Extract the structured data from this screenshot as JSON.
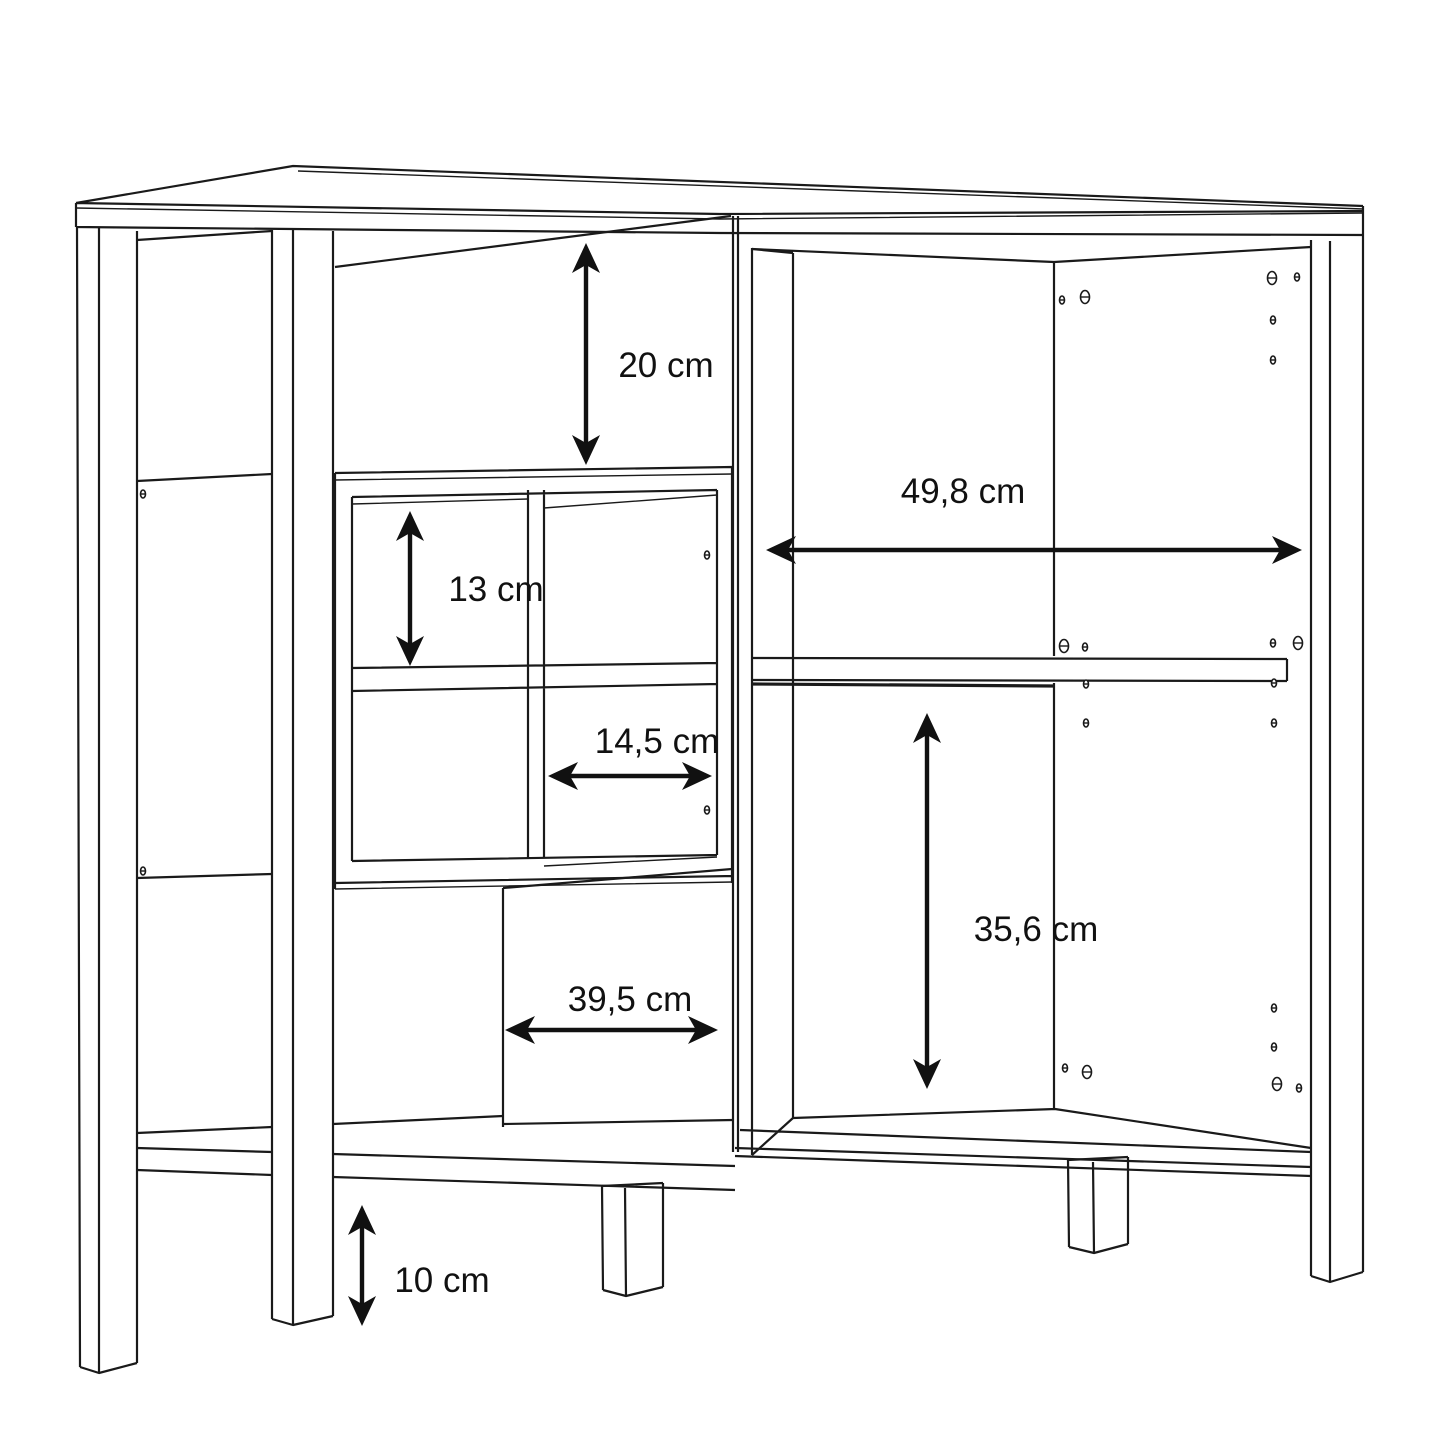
{
  "figure": {
    "type": "furniture-assembly-dimension-diagram",
    "subject": "sideboard-cabinet-line-drawing",
    "background_color": "#ffffff",
    "line_color": "#1a1a1a",
    "text_color": "#111111",
    "unit": "cm"
  },
  "dimensions": [
    {
      "id": "top-compartment-height",
      "value": "20",
      "unit": "cm",
      "label": "20 cm",
      "orientation": "vertical",
      "arrow": {
        "x": 586,
        "y1": 243,
        "y2": 465
      },
      "text": {
        "x": 666,
        "y": 377
      }
    },
    {
      "id": "cube-cell-height",
      "value": "13",
      "unit": "cm",
      "label": "13 cm",
      "orientation": "vertical",
      "arrow": {
        "x": 410,
        "y1": 511,
        "y2": 666
      },
      "text": {
        "x": 496,
        "y": 601
      }
    },
    {
      "id": "right-compartment-width",
      "value": "49,8",
      "unit": "cm",
      "label": "49,8 cm",
      "orientation": "horizontal",
      "arrow": {
        "y": 550,
        "x1": 766,
        "x2": 1302
      },
      "text": {
        "x": 963,
        "y": 503
      }
    },
    {
      "id": "cube-cell-width",
      "value": "14,5",
      "unit": "cm",
      "label": "14,5 cm",
      "orientation": "horizontal",
      "arrow": {
        "y": 776,
        "x1": 548,
        "x2": 712
      },
      "text": {
        "x": 657,
        "y": 753
      }
    },
    {
      "id": "right-compartment-height",
      "value": "35,6",
      "unit": "cm",
      "label": "35,6 cm",
      "orientation": "vertical",
      "arrow": {
        "x": 927,
        "y1": 713,
        "y2": 1089
      },
      "text": {
        "x": 1036,
        "y": 941
      }
    },
    {
      "id": "bottom-compartment-width",
      "value": "39,5",
      "unit": "cm",
      "label": "39,5 cm",
      "orientation": "horizontal",
      "arrow": {
        "y": 1030,
        "x1": 505,
        "x2": 718
      },
      "text": {
        "x": 630,
        "y": 1011
      }
    },
    {
      "id": "leg-height",
      "value": "10",
      "unit": "cm",
      "label": "10 cm",
      "orientation": "vertical",
      "arrow": {
        "x": 362,
        "y1": 1205,
        "y2": 1326
      },
      "text": {
        "x": 442,
        "y": 1292
      }
    }
  ],
  "screw_holes": [
    {
      "x": 143,
      "y": 494,
      "size": "small"
    },
    {
      "x": 143,
      "y": 871,
      "size": "small"
    },
    {
      "x": 707,
      "y": 555,
      "size": "small"
    },
    {
      "x": 707,
      "y": 810,
      "size": "small"
    },
    {
      "x": 1062,
      "y": 300,
      "size": "small"
    },
    {
      "x": 1085,
      "y": 297,
      "size": "large"
    },
    {
      "x": 1272,
      "y": 278,
      "size": "large"
    },
    {
      "x": 1297,
      "y": 277,
      "size": "small"
    },
    {
      "x": 1273,
      "y": 320,
      "size": "small"
    },
    {
      "x": 1273,
      "y": 360,
      "size": "small"
    },
    {
      "x": 1064,
      "y": 646,
      "size": "large"
    },
    {
      "x": 1085,
      "y": 647,
      "size": "small"
    },
    {
      "x": 1273,
      "y": 643,
      "size": "small"
    },
    {
      "x": 1298,
      "y": 643,
      "size": "large"
    },
    {
      "x": 1086,
      "y": 684,
      "size": "small"
    },
    {
      "x": 1274,
      "y": 683,
      "size": "small"
    },
    {
      "x": 1086,
      "y": 723,
      "size": "small"
    },
    {
      "x": 1274,
      "y": 723,
      "size": "small"
    },
    {
      "x": 1274,
      "y": 1008,
      "size": "small"
    },
    {
      "x": 1274,
      "y": 1047,
      "size": "small"
    },
    {
      "x": 1065,
      "y": 1068,
      "size": "small"
    },
    {
      "x": 1087,
      "y": 1072,
      "size": "large"
    },
    {
      "x": 1277,
      "y": 1084,
      "size": "large"
    },
    {
      "x": 1299,
      "y": 1088,
      "size": "small"
    }
  ]
}
